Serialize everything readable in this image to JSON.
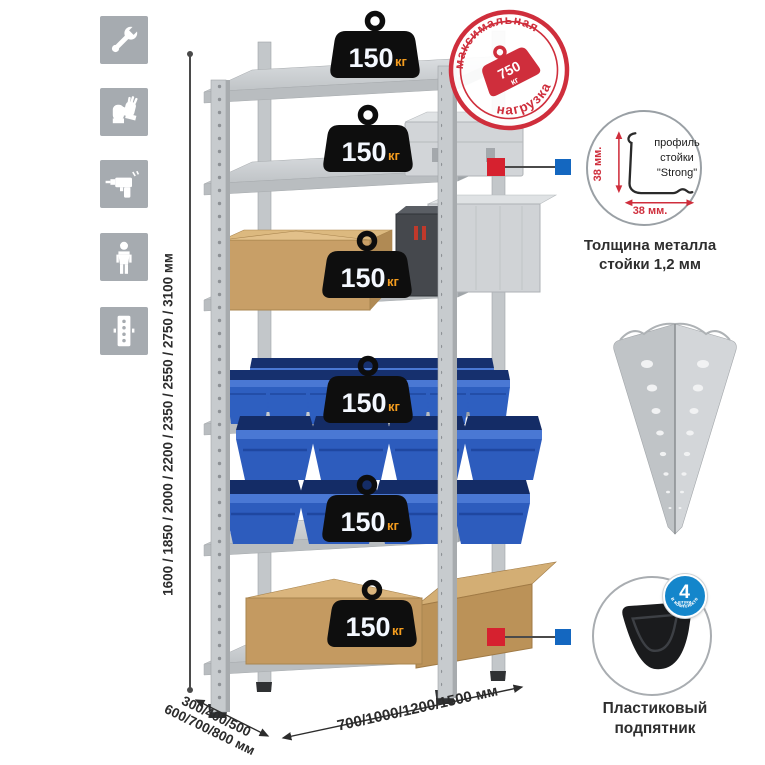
{
  "page": {
    "background": "#ffffff"
  },
  "assembly_icons": {
    "bg_color": "#a6abb0",
    "items": [
      {
        "icon": "wrench-icon"
      },
      {
        "icon": "gloves-icon"
      },
      {
        "icon": "drill-icon"
      },
      {
        "icon": "person-icon"
      },
      {
        "icon": "perforated-profile-icon"
      }
    ]
  },
  "dimensions": {
    "height_label": "1600 / 1850 / 2000 / 2200 / 2350 / 2550 / 2750 / 3100 мм",
    "depth_line1": "300/400/500",
    "depth_line2": "600/700/800 мм",
    "width_label": "700/1000/1200/1500 мм"
  },
  "shelf_load": {
    "value": "150",
    "unit": "кг",
    "badge_count": 6
  },
  "max_load_stamp": {
    "arc_top": "максимальная",
    "arc_bottom": "нагрузка",
    "value": "750",
    "unit": "кг",
    "color": "#cf2e3c"
  },
  "profile_detail": {
    "label_line1": "профиль",
    "label_line2": "стойки",
    "label_line3": "\"Strong\"",
    "dim_vertical": "38 мм.",
    "dim_horizontal": "38 мм.",
    "caption_line1": "Толщина металла",
    "caption_line2": "стойки 1,2 мм"
  },
  "foot_detail": {
    "badge_value": "4",
    "badge_unit": "штуки",
    "badge_arc": "в комплекте",
    "badge_color": "#1486cb",
    "caption_line1": "Пластиковый",
    "caption_line2": "подпятник"
  },
  "connector_colors": {
    "red": "#d6212f",
    "blue": "#1467c0"
  }
}
